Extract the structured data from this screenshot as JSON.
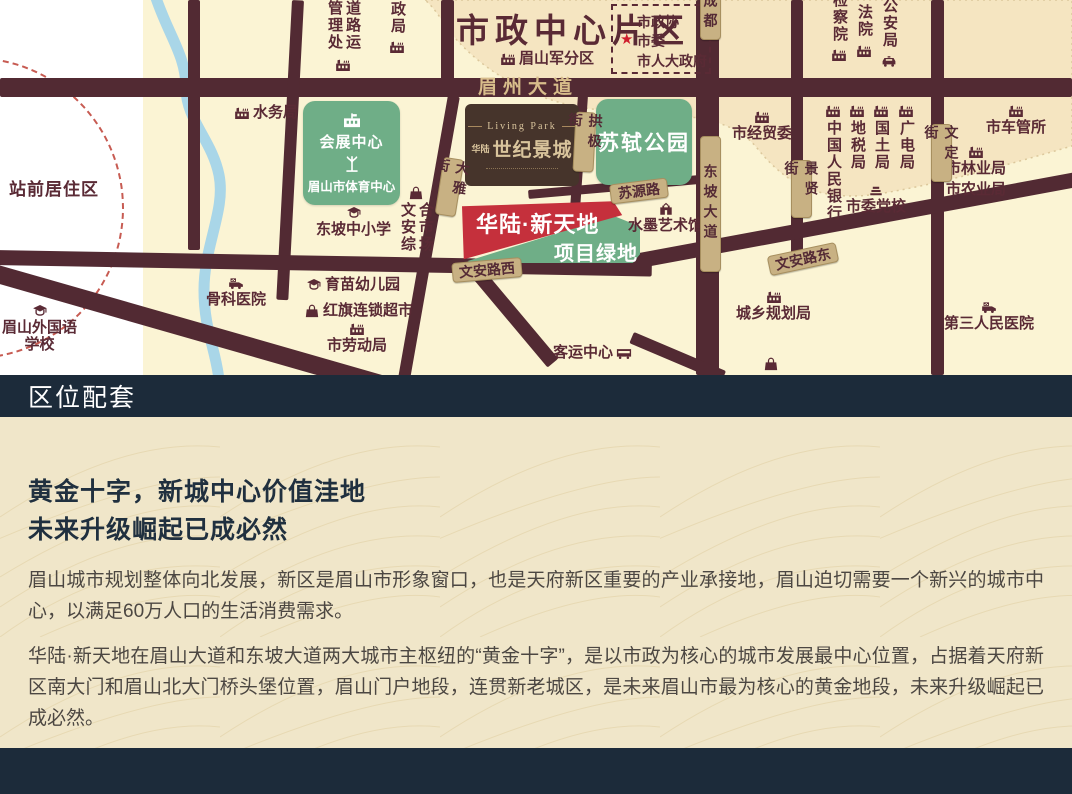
{
  "colors": {
    "navy": "#1c2b3a",
    "road": "#522a33",
    "map_cream": "#fbf4d4",
    "map_peach": "#f5e5c1",
    "badge_tan": "#c8b183",
    "green": "#6fae87",
    "red": "#c5303c",
    "brown_box": "#46342b",
    "river": "#a9d6e8",
    "content_bg": "#f0e6c9",
    "poi_text": "#5a2a35"
  },
  "map": {
    "labels": {
      "city_center": "市政中心片区",
      "station_area": "站前居住区"
    },
    "gov_box": {
      "star": "★",
      "lines": [
        "市政协",
        "市委",
        "市人大政府"
      ]
    },
    "landmarks": {
      "convention": {
        "line1": "会展中心",
        "line2": "眉山市体育中心"
      },
      "park": "苏轼公园",
      "century": {
        "en": "Living Park",
        "brand": "华陆",
        "name": "世纪景城"
      },
      "banner_red": "华陆·新天地",
      "banner_green": "项目绿地"
    },
    "road_labels": [
      {
        "t": "眉州大道",
        "x": 478,
        "y": 78,
        "type": "ontext",
        "w": 140
      },
      {
        "t": "成都",
        "x": 700,
        "y": -14,
        "type": "vbadge",
        "h": 52
      },
      {
        "t": "东坡大道",
        "x": 700,
        "y": 136,
        "type": "vbadge",
        "h": 134
      },
      {
        "t": "大雅街",
        "x": 439,
        "y": 158,
        "type": "vbadge",
        "h": 56,
        "rot": 9
      },
      {
        "t": "拱极街",
        "x": 574,
        "y": 112,
        "type": "vbadge",
        "h": 58,
        "rot": 3
      },
      {
        "t": "景贤街",
        "x": 791,
        "y": 160,
        "type": "vbadge",
        "h": 56
      },
      {
        "t": "文定街",
        "x": 931,
        "y": 124,
        "type": "vbadge",
        "h": 56
      },
      {
        "t": "苏源路",
        "x": 610,
        "y": 181,
        "type": "badge",
        "w": 56,
        "rot": -7
      },
      {
        "t": "文安路西",
        "x": 452,
        "y": 260,
        "type": "badge",
        "w": 68,
        "rot": -5
      },
      {
        "t": "文安路东",
        "x": 768,
        "y": 249,
        "type": "badge",
        "w": 68,
        "rot": -12
      }
    ],
    "pois": [
      {
        "t": "道路运管理处",
        "i": "factory",
        "o": "v",
        "x": 325,
        "y": 0,
        "th": 56
      },
      {
        "t": "邮政局",
        "i": "factory",
        "o": "v",
        "x": 388,
        "y": -16,
        "th": 54
      },
      {
        "t": "检察院",
        "i": "factory",
        "o": "v",
        "x": 830,
        "y": -8,
        "th": 54
      },
      {
        "t": "法院",
        "i": "factory",
        "o": "v",
        "x": 855,
        "y": 4,
        "th": 38
      },
      {
        "t": "公安局",
        "i": "police-car",
        "o": "v",
        "x": 880,
        "y": -2,
        "th": 54
      },
      {
        "t": "中国人民银行",
        "i": "factory",
        "o": "vi",
        "x": 824,
        "y": 104,
        "th": 108
      },
      {
        "t": "地税局",
        "i": "factory",
        "o": "vi",
        "x": 848,
        "y": 104,
        "th": 58
      },
      {
        "t": "国土局",
        "i": "factory",
        "o": "vi",
        "x": 872,
        "y": 104,
        "th": 58
      },
      {
        "t": "广电局",
        "i": "factory",
        "o": "vi",
        "x": 897,
        "y": 104,
        "th": 58
      },
      {
        "t": "文安综合市场",
        "i": "bag",
        "o": "vl",
        "x": 398,
        "y": 186,
        "th": 58
      },
      {
        "t": "水务局",
        "i": "factory",
        "o": "h",
        "x": 234,
        "y": 104
      },
      {
        "t": "眉山军分区",
        "i": "factory",
        "o": "h",
        "x": 500,
        "y": 50
      },
      {
        "t": "市经贸委",
        "i": "factory",
        "o": "it",
        "x": 732,
        "y": 110
      },
      {
        "t": "市委党校",
        "i": "book",
        "o": "it",
        "x": 846,
        "y": 183
      },
      {
        "t": "市车管所",
        "i": "factory",
        "o": "it",
        "x": 986,
        "y": 104
      },
      {
        "t": "市林业局",
        "i": "factory",
        "o": "it",
        "x": 946,
        "y": 145
      },
      {
        "t": "市农业局",
        "o": "t",
        "x": 946,
        "y": 181
      },
      {
        "t": "第三人民医院",
        "i": "ambulance",
        "o": "it",
        "x": 944,
        "y": 300
      },
      {
        "t": "城乡规划局",
        "i": "factory",
        "o": "it",
        "x": 736,
        "y": 290
      },
      {
        "t": "水墨艺术馆",
        "i": "museum",
        "o": "it",
        "x": 628,
        "y": 202
      },
      {
        "t": "骨科医院",
        "i": "ambulance",
        "o": "it",
        "x": 206,
        "y": 276
      },
      {
        "t": "眉山外国语|学校",
        "i": "school",
        "o": "it",
        "x": 2,
        "y": 304
      },
      {
        "t": "东坡中小学",
        "i": "school",
        "o": "it",
        "x": 316,
        "y": 206
      },
      {
        "t": "育苗幼儿园",
        "i": "school",
        "o": "h",
        "x": 306,
        "y": 276
      },
      {
        "t": "红旗连锁超市",
        "i": "bag",
        "o": "h",
        "x": 304,
        "y": 302
      },
      {
        "t": "市劳动局",
        "i": "factory",
        "o": "it",
        "x": 327,
        "y": 322
      },
      {
        "t": "客运中心",
        "i": "bus",
        "o": "hr",
        "x": 553,
        "y": 344
      },
      {
        "t": "",
        "i": "bag",
        "o": "i",
        "x": 763,
        "y": 357
      }
    ]
  },
  "section_header": {
    "title": "区位配套"
  },
  "content": {
    "title_line1": "黄金十字，新城中心价值洼地",
    "title_line2": "未来升级崛起已成必然",
    "paragraph1": "眉山城市规划整体向北发展，新区是眉山市形象窗口，也是天府新区重要的产业承接地，眉山迫切需要一个新兴的城市中心，以满足60万人口的生活消费需求。",
    "paragraph2": "华陆·新天地在眉山大道和东坡大道两大城市主枢纽的“黄金十字”，是以市政为核心的城市发展最中心位置，占据着天府新区南大门和眉山北大门桥头堡位置，眉山门户地段，连贯新老城区，是未来眉山市最为核心的黄金地段，未来升级崛起已成必然。"
  }
}
